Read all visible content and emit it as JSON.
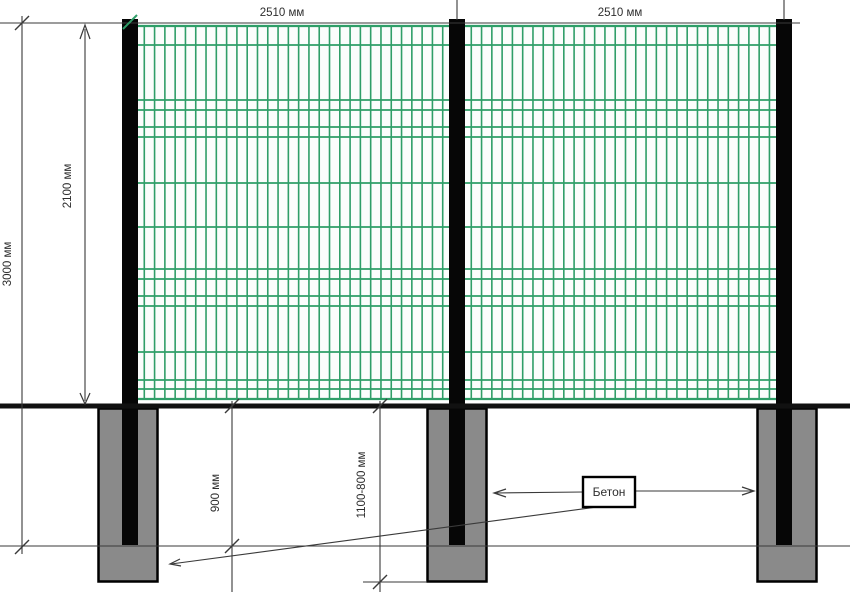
{
  "dimensions": {
    "panel_width_left": "2510 мм",
    "panel_width_right": "2510 мм",
    "post_total_height": "3000 мм",
    "panel_height": "2100 мм",
    "post_embed_depth": "900 мм",
    "foundation_depth": "1100-800 мм"
  },
  "labels": {
    "concrete": "Бетон"
  },
  "colors": {
    "mesh_green": "#2f9e68",
    "mesh_background": "#fbfdfc",
    "post_black": "#060606",
    "footing_gray": "#8a8a8a",
    "outline_black": "#000000",
    "dimension_line": "#3a3a3a",
    "text": "#2e2e2e",
    "ground": "#111111",
    "page_background": "#ffffff"
  }
}
